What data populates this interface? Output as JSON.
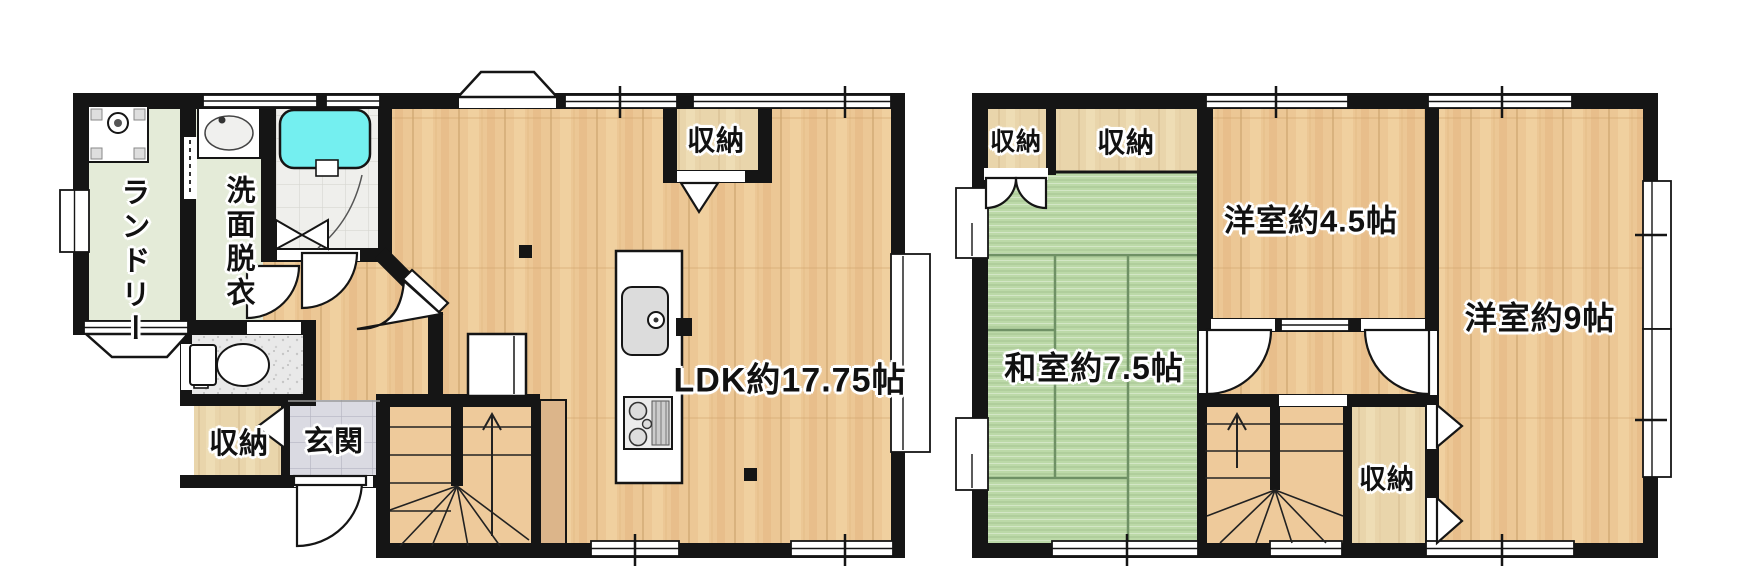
{
  "plan_1f": {
    "laundry": "ランドリー",
    "washroom": "洗面脱衣",
    "storage": "収納",
    "entrance": "玄関",
    "ldk_closet": "収納",
    "ldk": "LDK約17.75帖"
  },
  "plan_2f": {
    "closet_left": "収納",
    "closet_top": "収納",
    "western_room_45": "洋室約4.5帖",
    "japanese_room_75": "和室約7.5帖",
    "western_room_9": "洋室約9帖",
    "closet_bottom": "収納"
  },
  "colors": {
    "wall": "#151515",
    "bathtub": "#74eff0",
    "tatami": "#bcd9a8",
    "wood_floor": "#ecc795",
    "room_green": "#e4ebd8",
    "stair_wood": "#eeca9b"
  }
}
